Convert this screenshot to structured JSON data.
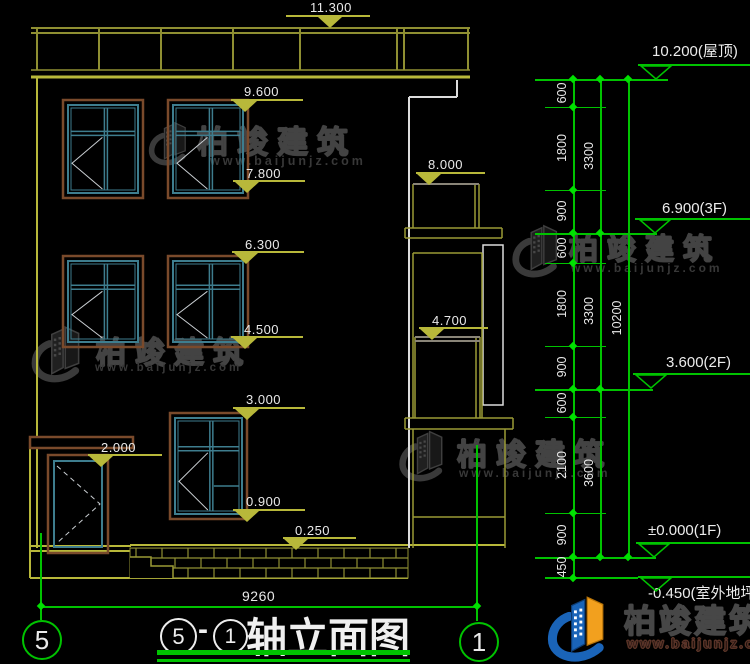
{
  "drawing": {
    "title": "轴立面图",
    "title_dash": "-",
    "title_circle_left": "5",
    "title_circle_right": "1",
    "axis_left_bubble": "5",
    "axis_right_bubble": "1",
    "bottom_width_dim": "9260"
  },
  "watermark": {
    "brand": "柏竣建筑",
    "site": "www.baijunjz.com"
  },
  "logo": {
    "brand": "柏竣建筑",
    "site": "www.baijunjz.com"
  },
  "colors": {
    "dim_green": "#00c300",
    "dim_olive": "#b8b83a",
    "frame_brown": "#7a4a2b",
    "frame_teal": "#3e7d8e",
    "logo_blue": "#1a64b8",
    "logo_orange": "#f2a01e"
  },
  "left_markers": [
    {
      "label": "11.300",
      "tx": 310,
      "ty": 0,
      "lx": 286,
      "lw": 84,
      "ly": 15,
      "trx": 318
    },
    {
      "label": "9.600",
      "tx": 244,
      "ty": 84,
      "lx": 231,
      "lw": 72,
      "ly": 99,
      "trx": 233
    },
    {
      "label": "7.800",
      "tx": 246,
      "ty": 166,
      "lx": 233,
      "lw": 72,
      "ly": 180,
      "trx": 235
    },
    {
      "label": "8.000",
      "tx": 428,
      "ty": 157,
      "lx": 416,
      "lw": 69,
      "ly": 172,
      "trx": 417
    },
    {
      "label": "6.300",
      "tx": 245,
      "ty": 237,
      "lx": 232,
      "lw": 72,
      "ly": 251,
      "trx": 234
    },
    {
      "label": "4.500",
      "tx": 244,
      "ty": 322,
      "lx": 231,
      "lw": 72,
      "ly": 336,
      "trx": 233
    },
    {
      "label": "4.700",
      "tx": 432,
      "ty": 313,
      "lx": 419,
      "lw": 69,
      "ly": 327,
      "trx": 420
    },
    {
      "label": "3.000",
      "tx": 246,
      "ty": 392,
      "lx": 233,
      "lw": 72,
      "ly": 407,
      "trx": 235
    },
    {
      "label": "0.900",
      "tx": 246,
      "ty": 494,
      "lx": 233,
      "lw": 72,
      "ly": 509,
      "trx": 235
    },
    {
      "label": "2.000",
      "tx": 101,
      "ty": 440,
      "lx": 88,
      "lw": 74,
      "ly": 454,
      "trx": 89
    },
    {
      "label": "0.250",
      "tx": 295,
      "ty": 523,
      "lx": 283,
      "lw": 73,
      "ly": 537,
      "trx": 284
    }
  ],
  "right_markers": [
    {
      "label": "10.200(屋顶)",
      "tx": 652,
      "ty": 40,
      "lx": 638,
      "lw": 112,
      "ly": 64,
      "trx": 640
    },
    {
      "label": "6.900(3F)",
      "tx": 662,
      "ty": 200,
      "lx": 635,
      "lw": 115,
      "ly": 218,
      "trx": 639
    },
    {
      "label": "3.600(2F)",
      "tx": 666,
      "ty": 354,
      "lx": 633,
      "lw": 117,
      "ly": 373,
      "trx": 635
    },
    {
      "label": "±0.000(1F)",
      "tx": 648,
      "ty": 522,
      "lx": 636,
      "lw": 114,
      "ly": 542,
      "trx": 638
    },
    {
      "label": "-0.450(室外地坪)",
      "tx": 648,
      "ty": 582,
      "lx": 638,
      "lw": 112,
      "ly": 576,
      "trx": 640
    }
  ],
  "level_lines": [
    {
      "x": 535,
      "y": 79,
      "w": 133
    },
    {
      "x": 535,
      "y": 233,
      "w": 122
    },
    {
      "x": 535,
      "y": 389,
      "w": 118
    },
    {
      "x": 535,
      "y": 557,
      "w": 121
    },
    {
      "x": 545,
      "y": 577,
      "w": 93
    }
  ],
  "stubs": [
    {
      "x": 545,
      "y": 107,
      "w": 61
    },
    {
      "x": 545,
      "y": 190,
      "w": 61
    },
    {
      "x": 545,
      "y": 263,
      "w": 61
    },
    {
      "x": 545,
      "y": 346,
      "w": 61
    },
    {
      "x": 545,
      "y": 417,
      "w": 61
    },
    {
      "x": 545,
      "y": 513,
      "w": 61
    },
    {
      "x": 545,
      "y": 578,
      "w": 61
    }
  ],
  "vertical_dims": [
    {
      "line_x": 573,
      "y1": 79,
      "y2": 578,
      "label_x": 562,
      "ticks": [
        79,
        107,
        190,
        233,
        263,
        346,
        389,
        417,
        513,
        557,
        578
      ],
      "labels": [
        {
          "t": "600",
          "y": 93
        },
        {
          "t": "1800",
          "y": 148
        },
        {
          "t": "900",
          "y": 211
        },
        {
          "t": "600",
          "y": 248
        },
        {
          "t": "1800",
          "y": 304
        },
        {
          "t": "900",
          "y": 367
        },
        {
          "t": "600",
          "y": 403
        },
        {
          "t": "2100",
          "y": 465
        },
        {
          "t": "900",
          "y": 535
        },
        {
          "t": "450",
          "y": 567
        }
      ]
    },
    {
      "line_x": 600,
      "y1": 79,
      "y2": 557,
      "label_x": 589,
      "ticks": [
        79,
        233,
        389,
        557
      ],
      "labels": [
        {
          "t": "3300",
          "y": 156
        },
        {
          "t": "3300",
          "y": 311
        },
        {
          "t": "3600",
          "y": 473
        }
      ]
    },
    {
      "line_x": 628,
      "y1": 79,
      "y2": 557,
      "label_x": 617,
      "ticks": [
        79,
        557
      ],
      "labels": [
        {
          "t": "10200",
          "y": 318
        }
      ]
    }
  ],
  "watermarks_layout": [
    {
      "ix": 146,
      "iy": 114,
      "iw": 48,
      "ih": 56,
      "tx": 197,
      "ty": 117,
      "ts": 31,
      "ux": 210,
      "uy": 154,
      "us": 12.5
    },
    {
      "ix": 509,
      "iy": 220,
      "iw": 58,
      "ih": 58,
      "tx": 569,
      "ty": 226,
      "ts": 29,
      "ux": 571,
      "uy": 261,
      "us": 12
    },
    {
      "ix": 24,
      "iy": 321,
      "iw": 70,
      "ih": 62,
      "tx": 96,
      "ty": 328,
      "ts": 30,
      "ux": 95,
      "uy": 362,
      "us": 11.5
    },
    {
      "ix": 394,
      "iy": 426,
      "iw": 60,
      "ih": 56,
      "tx": 457,
      "ty": 430,
      "ts": 30,
      "ux": 459,
      "uy": 466,
      "us": 12
    }
  ]
}
